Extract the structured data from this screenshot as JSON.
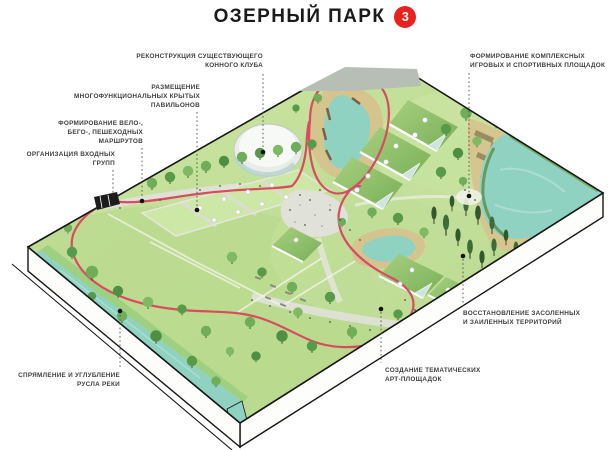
{
  "title": {
    "text": "ОЗЕРНЫЙ ПАРК",
    "badge": "3"
  },
  "callouts": {
    "reconstruction": {
      "lines": [
        "РЕКОНСТРУКЦИЯ СУЩЕСТВУЮЩЕГО",
        "КОННОГО КЛУБА"
      ]
    },
    "pavilions": {
      "lines": [
        "РАЗМЕЩЕНИЕ",
        "МНОГОФУНКЦИОНАЛЬНЫХ КРЫТЫХ",
        "ПАВИЛЬОНОВ"
      ]
    },
    "routes": {
      "lines": [
        "ФОРМИРОВАНИЕ ВЕЛО-,",
        "БЕГО-, ПЕШЕХОДНЫХ",
        "МАРШРУТОВ"
      ]
    },
    "entrance": {
      "lines": [
        "ОРГАНИЗАЦИЯ ВХОДНЫХ",
        "ГРУПП"
      ]
    },
    "sport": {
      "lines": [
        "ФОРМИРОВАНИЕ КОМПЛЕКСНЫХ",
        "ИГРОВЫХ И СПОРТИВНЫХ ПЛОЩАДОК"
      ]
    },
    "restore": {
      "lines": [
        "ВОССТАНОВЛЕНИЕ ЗАСОЛЕННЫХ",
        "И ЗАИЛЕННЫХ ТЕРРИТОРИЙ"
      ]
    },
    "art": {
      "lines": [
        "СОЗДАНИЕ ТЕМАТИЧЕСКИХ",
        "АРТ-ПЛОЩАДОК"
      ]
    },
    "river": {
      "lines": [
        "СПРЯМЛЕНИЕ И УГЛУБЛЕНИЕ",
        "РУСЛА РЕКИ"
      ]
    }
  },
  "colors": {
    "badge": "#e8231e",
    "route": "#d84b60",
    "water": "#8fd2c2",
    "sand": "#d6c48f",
    "label_text": "#3f3f3f",
    "title_text": "#1a1a1a"
  }
}
